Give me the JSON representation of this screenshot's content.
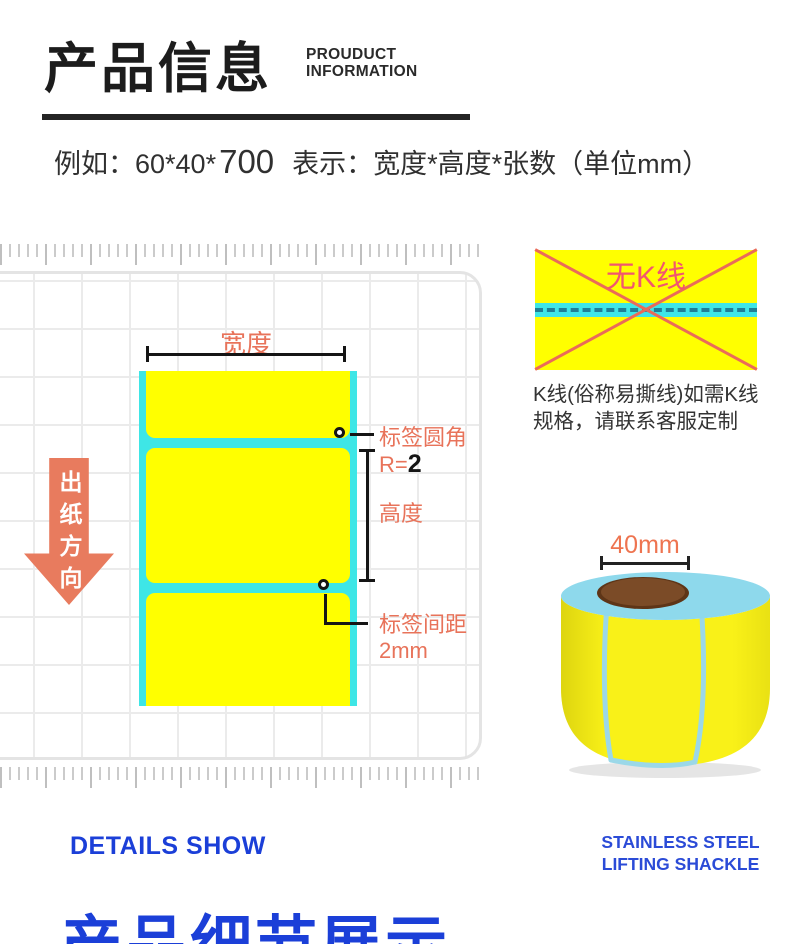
{
  "header": {
    "title": "产品信息",
    "subtitle_line1": "PROUDUCT",
    "subtitle_line2": "INFORMATION",
    "example_prefix": "例如：60*40*",
    "example_count": "700",
    "example_suffix": "  表示：宽度*高度*张数（单位mm）"
  },
  "diagram": {
    "width_label": "宽度",
    "corner_label": "标签圆角",
    "corner_radius_prefix": "R=",
    "corner_radius_value": "2",
    "height_label": "高度",
    "gap_label": "标签间距",
    "gap_value": "2mm",
    "feed_direction_label": "出纸方向"
  },
  "kline": {
    "no_kline_label": "无K线",
    "note_line1": "K线(俗称易撕线)如需K线",
    "note_line2": "规格，请联系客服定制"
  },
  "roll": {
    "core_width_label": "40mm"
  },
  "footer": {
    "details_show": "DETAILS SHOW",
    "right_line1": "STAINLESS STEEL",
    "right_line2": "LIFTING SHACKLE",
    "section_title": "产品细节展示"
  },
  "colors": {
    "accent_orange": "#E8735A",
    "arrow_coral": "#E87B5E",
    "liner_cyan": "#3EE6E6",
    "label_yellow": "#FFFF00",
    "brand_blue": "#1B3FD8",
    "no_kline_pink": "#F2566F",
    "roll_core_brown": "#7B4B27"
  }
}
